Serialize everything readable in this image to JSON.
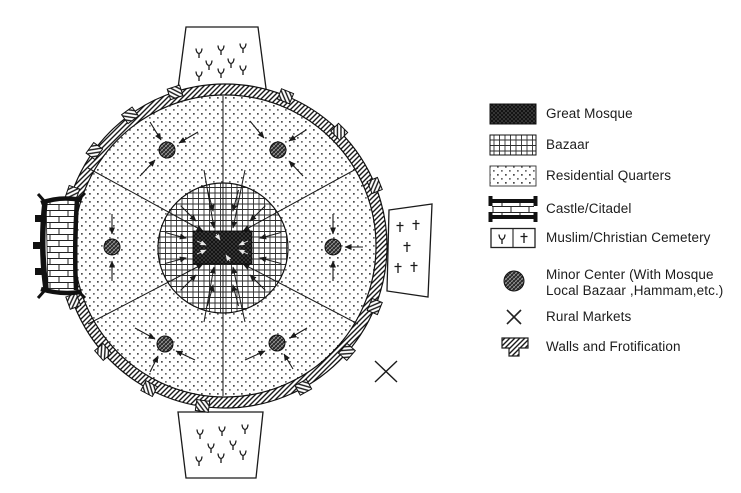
{
  "legend": {
    "items": [
      {
        "id": "great-mosque",
        "label": "Great Mosque"
      },
      {
        "id": "bazaar",
        "label": "Bazaar"
      },
      {
        "id": "residential",
        "label": "Residential Quarters"
      },
      {
        "id": "castle-citadel",
        "label": "Castle/Citadel"
      },
      {
        "id": "cemetery",
        "label": "Muslim/Christian Cemetery"
      },
      {
        "id": "minor-center",
        "label": "Minor Center (With Mosque",
        "label2": "Local Bazaar ,Hammam,etc.)"
      },
      {
        "id": "rural-markets",
        "label": "Rural Markets"
      },
      {
        "id": "walls",
        "label": "Walls and Frotification"
      }
    ]
  },
  "map": {
    "symbols": [
      {
        "name": "muslim-grave-symbol",
        "glyph": "Y"
      },
      {
        "name": "christian-grave-symbol",
        "glyph": "†"
      },
      {
        "name": "rural-market-symbol",
        "glyph": "×"
      }
    ],
    "minor_center_count": 6,
    "cemetery_count": 3
  },
  "colors": {
    "ink": "#1a1a1a",
    "paper": "#ffffff"
  }
}
